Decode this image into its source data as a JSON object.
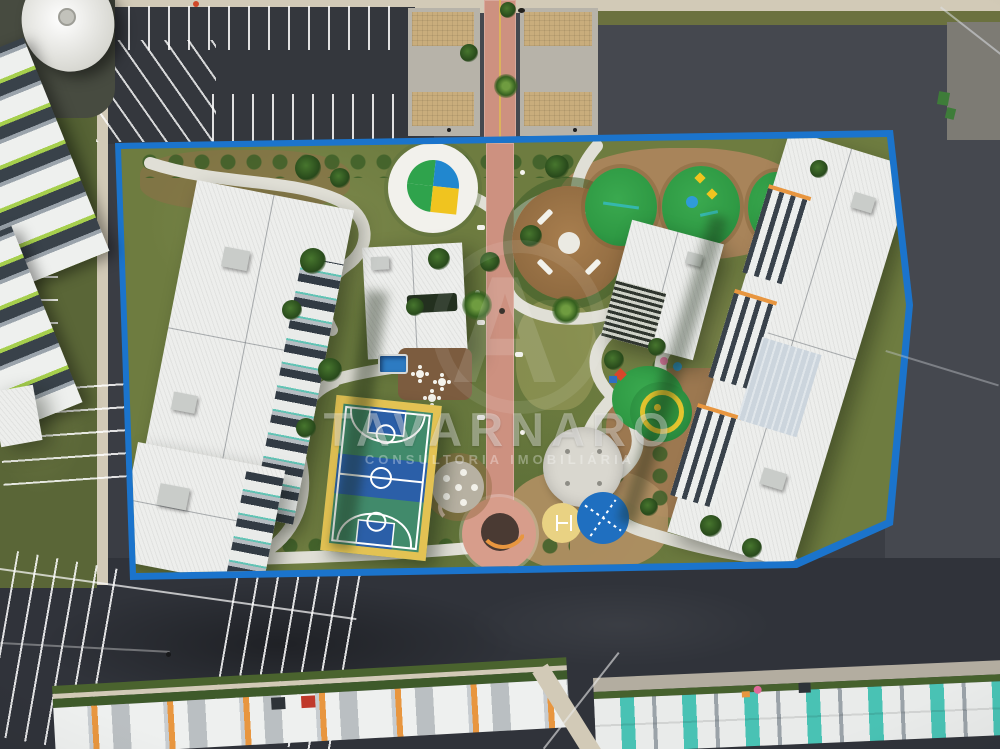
{
  "meta": {
    "title": "Aerial drone view of a residential condominium with central leisure area"
  },
  "watermark": {
    "brand": "TAVARNARO",
    "tagline": "CONSULTORIA IMOBILIÁRIA",
    "monogram": "A"
  },
  "palette": {
    "asphalt": "#3a3d44",
    "asphalt_dark": "#30333a",
    "asphalt_park": "#34373d",
    "asphalt_light": "#45484f",
    "concrete": "#b7b3a9",
    "concrete_top": "#7d7b74",
    "sidewalk": "#d2cab7",
    "grass_base": "#6e7c40",
    "grass_left": "#5a6637",
    "grass_band": "#6b713f",
    "mulch": "#a8845a",
    "mulch_dark": "#9c7850",
    "mulch_pad": "#c9ad7c",
    "blue_band": "#1b74cc",
    "path_white": "#e0dfd6",
    "hedge_green": "#3f5b28",
    "pink_path": "#cd9180",
    "pink_plaza": "#d79d8b",
    "roof_white": "#edeeec",
    "balcony_dark": "#323b44",
    "teal_accent": "#56c1b1",
    "lime_accent": "#a6cf4d",
    "orange_accent": "#e8963f",
    "court_yellow": "#e3c253",
    "court_green": "#418a6b",
    "court_blue": "#2b5fa8",
    "pool_blue": "#2d7bc2",
    "play_green": "#2f9a44",
    "logo_green": "#2fa34c",
    "logo_blue": "#2187cf",
    "logo_yellow": "#f0c41f",
    "plaza_white": "#d9d7cf",
    "plaza_blue": "#1f6fc0",
    "plaza_yellow": "#e9d283",
    "slide_red": "#d8472b",
    "dumpster_green": "#3e7c39"
  },
  "scene": {
    "type": "aerial-drone-photo",
    "features": [
      "white apartment building (left)",
      "white apartment building (right)",
      "row houses under construction (bottom edge)",
      "lime-accent buildings and water tank tower (left edge)",
      "asphalt parking lots with fresh white stall striping",
      "central leisure block outlined by a blue painted band",
      "brick central promenade with palm trees",
      "condominium logo painted inside a white circle",
      "circular lounge plaza with four white benches",
      "kids playground on green rubber mounds",
      "basketball / multisport court",
      "small swimming pool, deck and tables",
      "event circles: white, blue and yellow",
      "winding white concrete paths",
      "power lines crossing the access roads"
    ]
  }
}
